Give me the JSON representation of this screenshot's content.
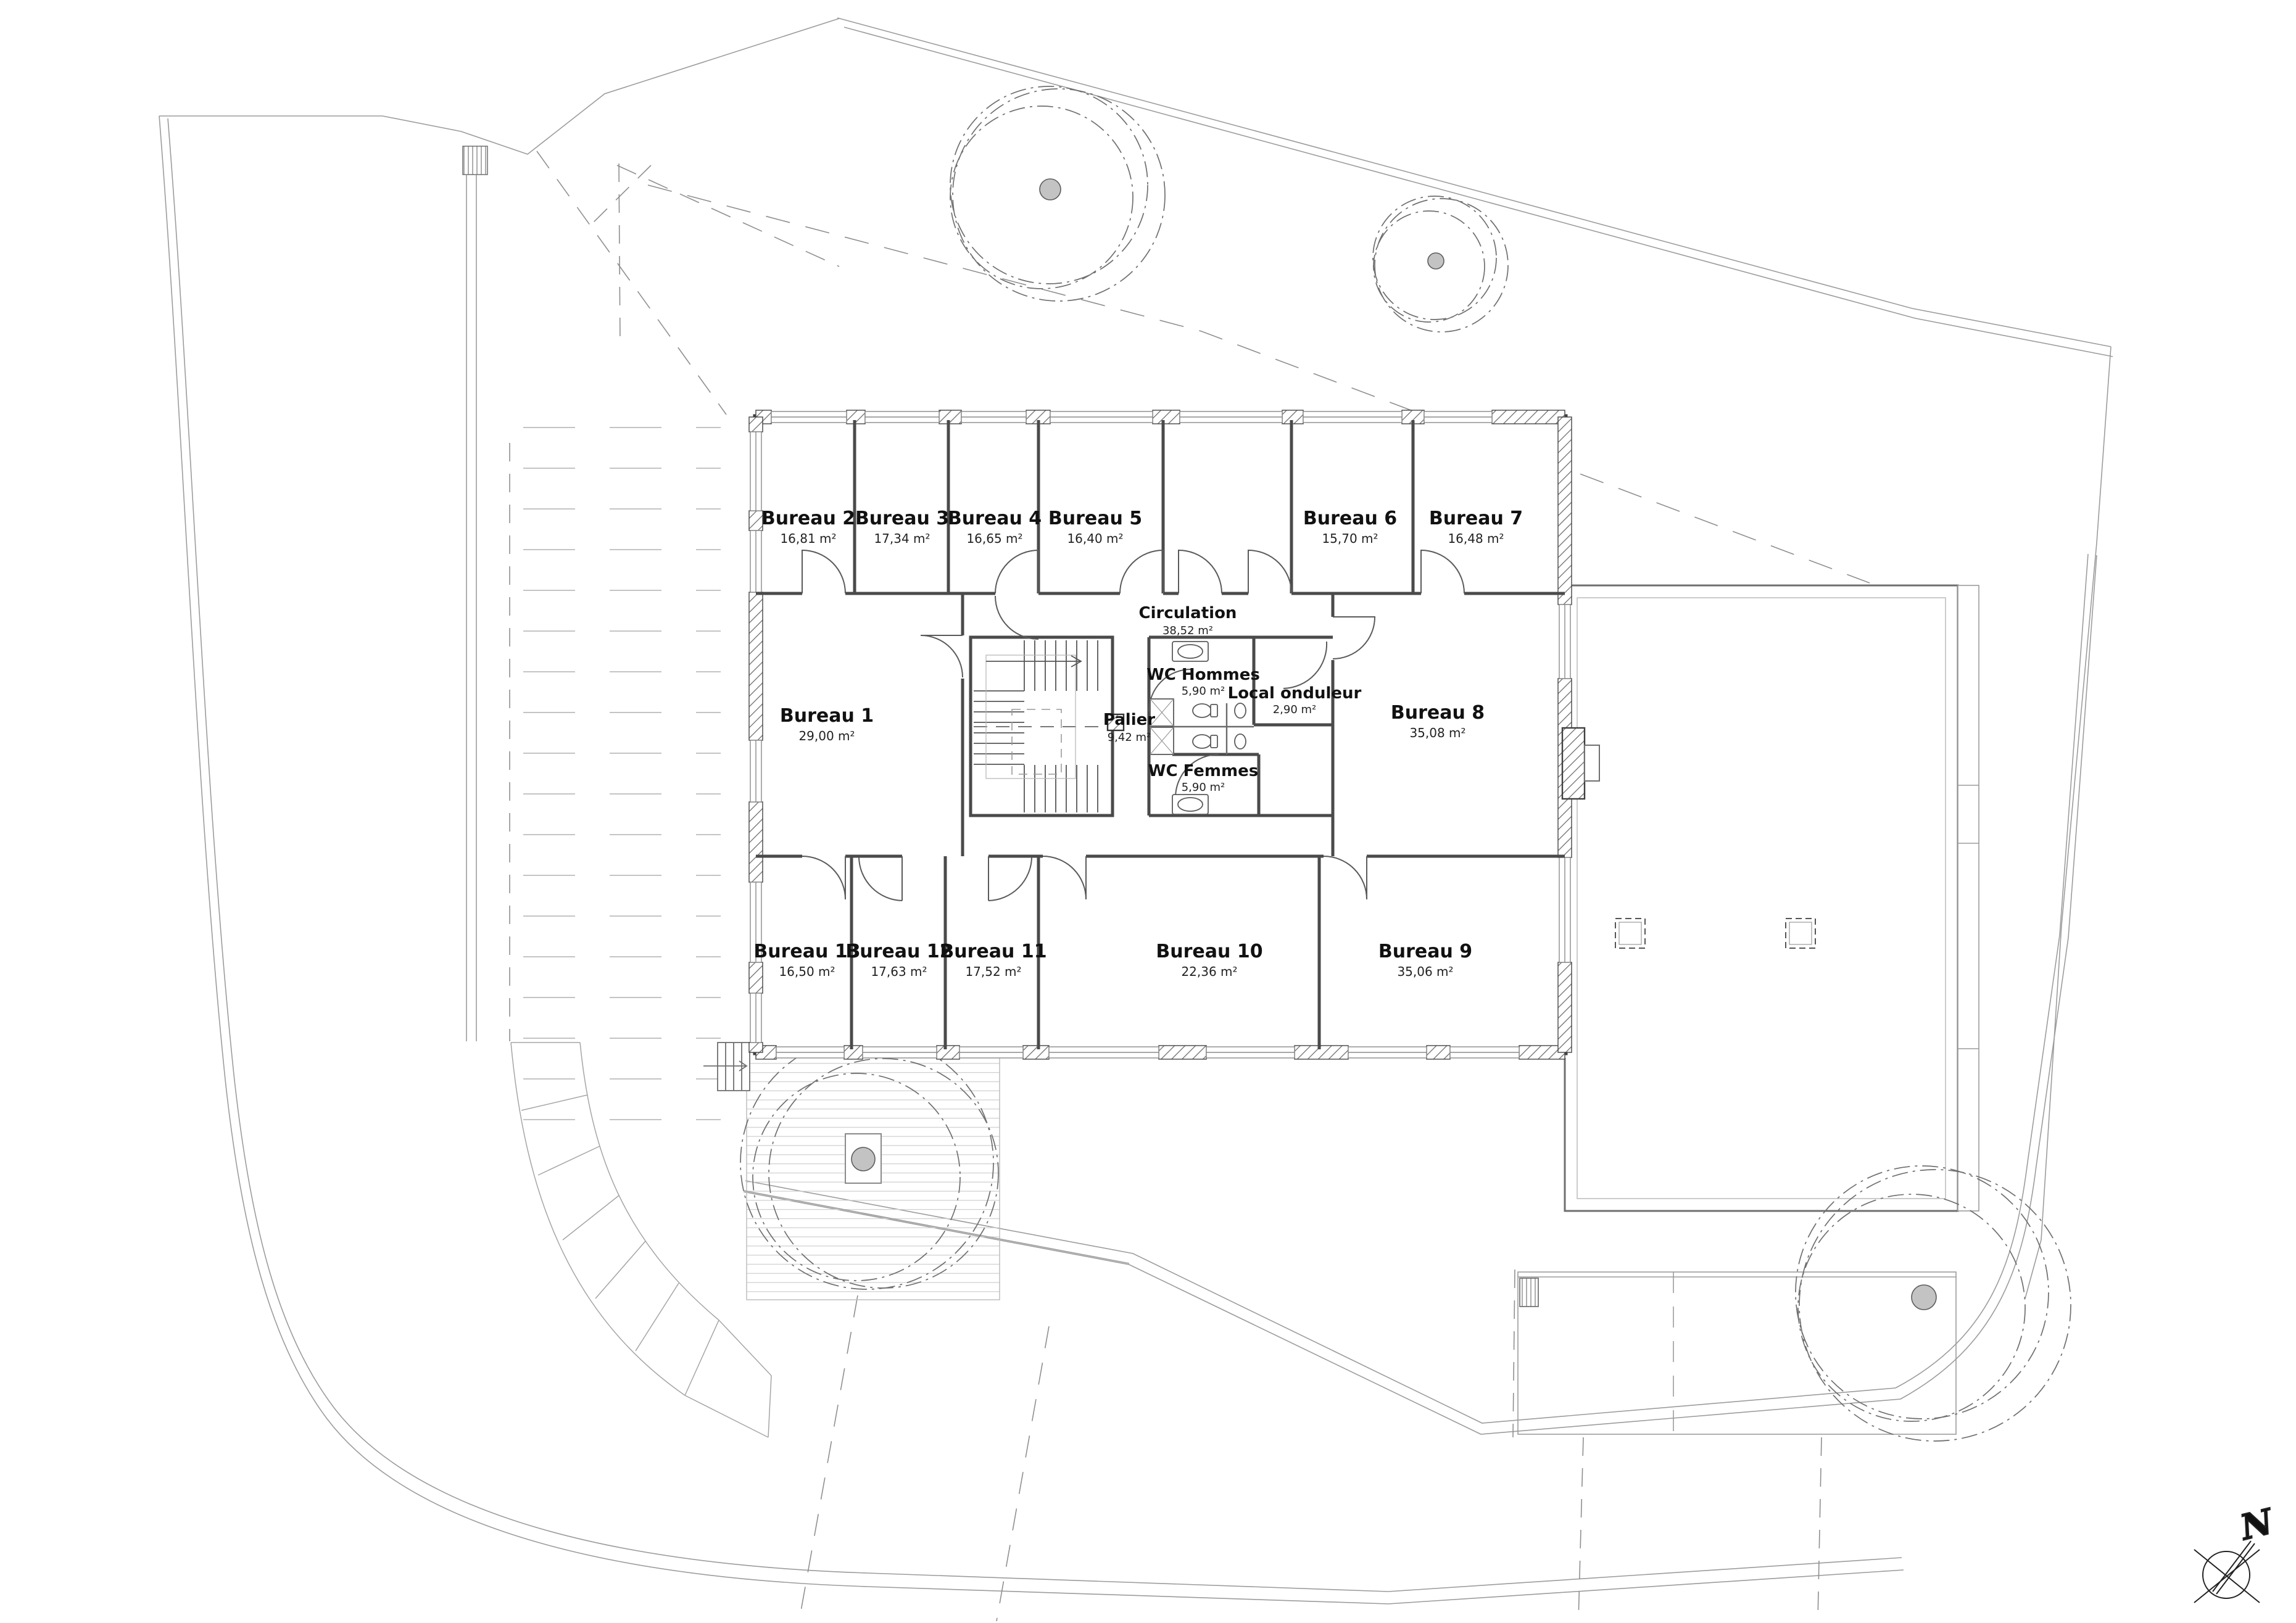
{
  "rooms": {
    "b1": {
      "name": "Bureau 1",
      "area": "29,00 m²"
    },
    "b2": {
      "name": "Bureau 2",
      "area": "16,81 m²"
    },
    "b3": {
      "name": "Bureau 3",
      "area": "17,34 m²"
    },
    "b4": {
      "name": "Bureau 4",
      "area": "16,65 m²"
    },
    "b5": {
      "name": "Bureau 5",
      "area": "16,40 m²"
    },
    "b6": {
      "name": "Bureau 6",
      "area": "15,70 m²"
    },
    "b7": {
      "name": "Bureau 7",
      "area": "16,48 m²"
    },
    "b8": {
      "name": "Bureau 8",
      "area": "35,08 m²"
    },
    "b9": {
      "name": "Bureau 9",
      "area": "35,06 m²"
    },
    "b10": {
      "name": "Bureau 10",
      "area": "22,36 m²"
    },
    "b11": {
      "name": "Bureau 11",
      "area": "17,52 m²"
    },
    "b12": {
      "name": "Bureau 12",
      "area": "17,63 m²"
    },
    "b13": {
      "name": "Bureau 13",
      "area": "16,50 m²"
    },
    "circulation": {
      "name": "Circulation",
      "area": "38,52 m²"
    },
    "palier": {
      "name": "Palier",
      "area": "9,42 m²"
    },
    "wc_hommes": {
      "name": "WC Hommes",
      "area": "5,90 m²"
    },
    "wc_femmes": {
      "name": "WC Femmes",
      "area": "5,90 m²"
    },
    "local_onduleur": {
      "name": "Local onduleur",
      "area": "2,90 m²"
    }
  },
  "compass": {
    "north_label": "N"
  },
  "colors": {
    "wall": "#3f3f3f",
    "partition": "#4a4a4a",
    "site_line": "#9c9c9c",
    "tree_canopy": "#6f6f6f",
    "tree_trunk": "#c3c3c3"
  }
}
